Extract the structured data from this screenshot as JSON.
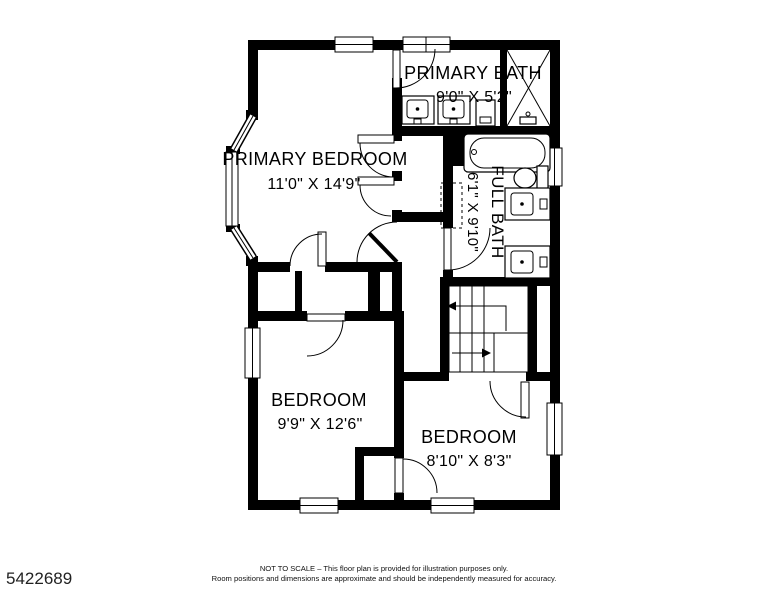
{
  "plan": {
    "rooms": {
      "primary_bath": {
        "name": "PRIMARY BATH",
        "dims": "9'0\" X 5'2\""
      },
      "primary_bedroom": {
        "name": "PRIMARY BEDROOM",
        "dims": "11'0\" X 14'9\""
      },
      "full_bath": {
        "name": "FULL BATH",
        "dims": "6'1\" X 9'10\""
      },
      "bedroom_1": {
        "name": "BEDROOM",
        "dims": "9'9\" X 12'6\""
      },
      "bedroom_2": {
        "name": "BEDROOM",
        "dims": "8'10\" X 8'3\""
      }
    }
  },
  "footer": {
    "listing_id": "5422689",
    "disclaimer_line1": "NOT TO SCALE – This floor plan is provided for illustration purposes only.",
    "disclaimer_line2": "Room positions and dimensions are approximate and should be independently measured for accuracy."
  },
  "colors": {
    "wall": "#000000",
    "background": "#ffffff"
  }
}
